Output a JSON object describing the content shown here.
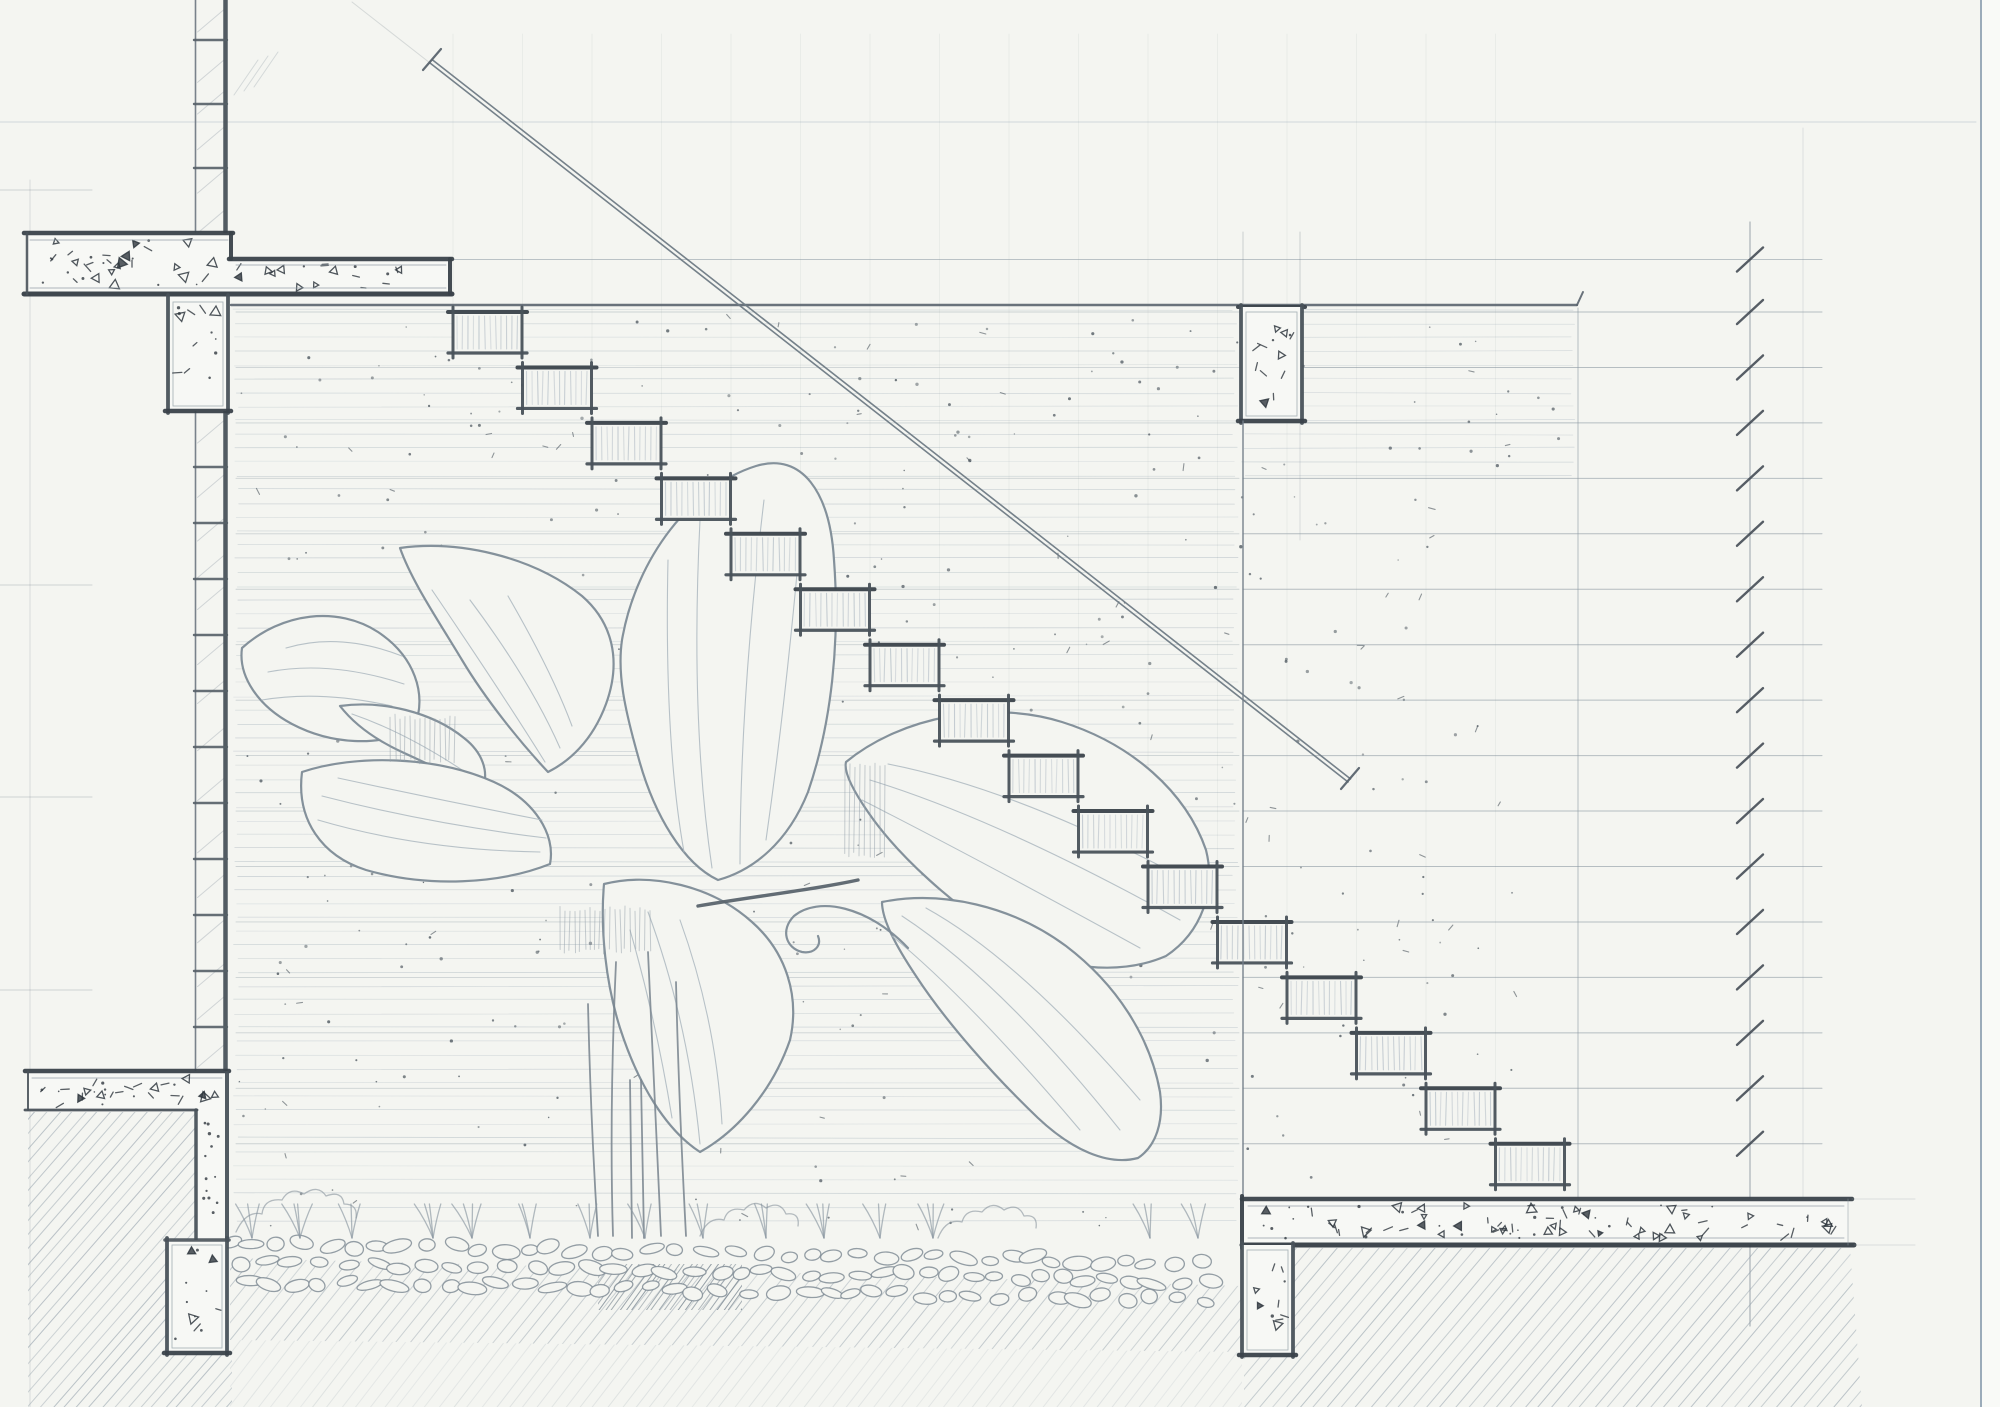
{
  "scene": {
    "width": 2000,
    "height": 1407,
    "rng_seed": 7,
    "palette": {
      "paper": "#f4f5f1",
      "paper_bright": "#f7f8f5",
      "ink_dark": "#3a424a",
      "ink_mid2": "#49525a",
      "ink_med": "#6b7680",
      "ink_light": "#8b98a2",
      "ink_faint": "#aab6bf",
      "step_hatch": "#b3bdc6",
      "leaf": "#7d8b96",
      "leaf_vein": "#a8b4bd",
      "hatch": "#93a0ab",
      "pebble": "#7b8791",
      "border_blue": "#7d92a6",
      "mark": "#2f373e"
    },
    "guides": {
      "top_hline_y": 122,
      "margin_vline_x": 30,
      "margin_tick_ys": [
        190,
        585,
        797,
        990
      ],
      "border_x": 1981,
      "pitch_ext": [
        352,
        2,
        430,
        63
      ]
    },
    "stairs": {
      "count": 16,
      "x0": 453,
      "y0": 312,
      "dx": 69.5,
      "dy": 55.45,
      "tread_w": 69,
      "riser_h": 41
    },
    "pitch": {
      "x1": 430,
      "y1": 63,
      "x2": 1348,
      "y2": 782,
      "gap": 4
    },
    "levels": {
      "tick_x": 1750,
      "line_x0": 1243,
      "line_x1": 1822,
      "first_y": 259.5,
      "spacing": 55.45,
      "count": 17,
      "vline_top": 222,
      "vline_bot": 1326
    },
    "wall_top_line": {
      "y": 305,
      "x0": 231,
      "x1": 1577
    },
    "wall_left": {
      "x_thin": 195.5,
      "x_thick": 225.5,
      "seg1": [
        0,
        232
      ],
      "seg2": [
        411,
        1071
      ],
      "rungs_top": [
        40,
        104,
        168
      ],
      "rung_start": 467,
      "rung_step": 56,
      "rung_end": 1062
    },
    "texture": {
      "bands": [
        {
          "x0": 233,
          "x1": 1238,
          "y0": 310,
          "y1": 1233,
          "step": 13.8
        },
        {
          "x0": 1241,
          "x1": 1576,
          "y0": 310,
          "y1": 479,
          "step": 13.8
        }
      ]
    },
    "stipple_regions": [
      {
        "x": 235,
        "y": 315,
        "w": 1335,
        "h": 163,
        "n": 110
      },
      {
        "x": 235,
        "y": 480,
        "w": 1000,
        "h": 750,
        "n": 240
      },
      {
        "x": 1240,
        "y": 480,
        "w": 278,
        "h": 700,
        "n": 80
      }
    ],
    "extra_vlines": [
      {
        "x": 1578,
        "y0": 308,
        "y1": 1197,
        "w": 1,
        "op": 0.6
      },
      {
        "x": 1803,
        "y0": 128,
        "y1": 1197,
        "w": 0.9,
        "op": 0.25
      },
      {
        "x": 1300,
        "y0": 422,
        "y1": 540,
        "w": 0.9,
        "op": 0.3
      }
    ],
    "concrete": {
      "slab_tl": {
        "rects": [
          [
            27,
            233,
            204,
            61
          ],
          [
            231,
            259,
            219,
            35
          ]
        ],
        "stipple": [
          [
            34,
            240,
            190,
            46,
            34
          ],
          [
            238,
            264,
            202,
            24,
            18
          ]
        ]
      },
      "col_tl": {
        "x": 168,
        "y": 297,
        "w": 60,
        "h": 114,
        "n": 13
      },
      "col_tr": {
        "x": 1241,
        "y": 307,
        "w": 61,
        "h": 114,
        "n": 13,
        "ext_above": 232
      },
      "slab_r": {
        "x": 1242,
        "y": 1199,
        "w": 606,
        "h": 46,
        "n": 85
      },
      "col_br": {
        "x": 1242,
        "y": 1245,
        "w": 51,
        "h": 110,
        "n": 10
      },
      "slab_bl": {
        "band": [
          28,
          1071,
          199,
          40
        ],
        "drop": [
          196,
          1111,
          31,
          130
        ],
        "n_band": 30,
        "n_drop": 13
      },
      "col_bl": {
        "x": 167,
        "y": 1240,
        "w": 60,
        "h": 113,
        "n": 12
      }
    },
    "hatches": [
      {
        "name": "ground-hatch-bottom-left",
        "poly": [
          [
            28,
            1112
          ],
          [
            196,
            1112
          ],
          [
            196,
            1353
          ],
          [
            232,
            1353
          ],
          [
            232,
            1407
          ],
          [
            28,
            1407
          ]
        ],
        "sp": 12.5,
        "op": 0.5
      },
      {
        "name": "ground-hatch-under-pebbles",
        "poly": [
          [
            230,
            1258
          ],
          [
            700,
            1270
          ],
          [
            1242,
            1286
          ],
          [
            1242,
            1352
          ],
          [
            230,
            1340
          ]
        ],
        "sp": 14,
        "op": 0.42
      },
      {
        "name": "ground-hatch-under-pebbles-fade",
        "poly": [
          [
            230,
            1340
          ],
          [
            1242,
            1352
          ],
          [
            1242,
            1407
          ],
          [
            230,
            1407
          ]
        ],
        "sp": 14,
        "op": 0.18
      },
      {
        "name": "ground-hatch-bottom-right",
        "poly": [
          [
            1244,
            1248
          ],
          [
            1850,
            1248
          ],
          [
            1862,
            1407
          ],
          [
            1244,
            1407
          ]
        ],
        "sp": 14,
        "op": 0.5
      },
      {
        "name": "trunk-shadow-hatch",
        "poly": [
          [
            598,
            1264
          ],
          [
            742,
            1264
          ],
          [
            742,
            1310
          ],
          [
            598,
            1310
          ]
        ],
        "sp": 6.5,
        "op": 0.7,
        "color": "#7a8791"
      }
    ],
    "pebbles": {
      "x0": 232,
      "x1": 1232,
      "row_ys": [
        1243,
        1262,
        1281
      ],
      "slope": 0.02
    },
    "sprig_xs": [
      252,
      300,
      352,
      433,
      472,
      530,
      590,
      645,
      703,
      766,
      824,
      880,
      933,
      1150,
      1198
    ],
    "clouds": [
      "M 236 1232 q 10 -22 26 -18 q 2 -16 20 -14 q 8 -14 22 -6 q 14 -10 22 2 q 16 -6 18 8 q 14 0 12 14",
      "M 700 1236 q 8 -20 24 -16 q 4 -14 20 -10 q 10 -12 22 -2 q 14 -8 20 6 q 14 -2 12 12",
      "M 938 1238 q 8 -20 24 -16 q 4 -14 20 -10 q 10 -12 22 -2 q 14 -8 20 6 q 14 -2 12 12"
    ],
    "plant": {
      "leaves": [
        {
          "d": "M 242 648 C 282 612 338 606 378 632 C 414 656 428 694 414 728 C 380 748 330 744 292 724 C 258 706 238 676 242 648 Z",
          "veins": [
            "M 262 700 Q 320 690 392 706",
            "M 268 672 Q 330 660 404 684",
            "M 286 648 Q 340 632 402 656"
          ]
        },
        {
          "d": "M 400 548 C 458 540 532 556 582 596 C 612 622 622 660 606 704 C 592 742 568 762 548 772 C 520 742 486 700 462 660 C 438 620 412 582 400 548 Z",
          "veins": [
            "M 545 762 Q 500 690 432 590",
            "M 560 748 Q 530 680 470 600",
            "M 572 726 Q 552 672 508 596"
          ]
        },
        {
          "d": "M 340 706 C 382 700 432 712 464 738 C 482 752 490 772 482 790 C 458 778 428 764 402 752 C 376 740 354 724 340 706 Z",
          "veins": [
            "M 352 714 Q 410 734 474 778"
          ]
        },
        {
          "d": "M 302 772 C 356 754 436 756 494 782 C 534 800 556 834 550 864 C 500 884 428 888 366 870 C 322 856 296 820 302 772 Z",
          "veins": [
            "M 318 820 Q 420 850 540 852",
            "M 322 796 Q 430 824 546 838",
            "M 338 778 Q 440 800 542 820"
          ]
        },
        {
          "d": "M 604 884 C 652 872 712 886 752 922 C 786 952 800 996 790 1040 C 772 1092 736 1132 700 1152 C 666 1130 638 1084 620 1028 C 606 984 600 930 604 884 Z",
          "veins": [
            "M 700 1144 Q 688 1020 648 912",
            "M 722 1124 Q 716 1020 680 920",
            "M 672 1118 Q 656 1020 630 930"
          ]
        },
        {
          "d": "M 622 640 C 636 558 692 486 756 466 C 802 452 830 492 834 560 C 840 640 832 722 808 792 C 788 842 754 870 718 880 C 684 864 654 816 638 756 C 625 710 617 674 622 640 Z",
          "veins": [
            "M 712 868 Q 690 720 700 520",
            "M 740 864 Q 740 700 764 500",
            "M 684 852 Q 664 740 668 560",
            "M 766 840 Q 786 700 800 540"
          ]
        },
        {
          "d": "M 846 762 C 902 716 992 700 1062 722 C 1132 744 1186 792 1206 850 C 1216 890 1202 932 1166 956 C 1120 976 1058 970 1008 940 C 954 906 898 856 868 812 C 850 786 844 770 846 762 Z",
          "veins": [
            "M 870 780 Q 1000 820 1180 920",
            "M 888 764 Q 1010 788 1168 870",
            "M 862 800 Q 980 860 1140 948"
          ]
        },
        {
          "d": "M 882 902 C 942 890 1012 906 1066 946 C 1116 984 1150 1036 1160 1092 C 1164 1122 1156 1146 1138 1158 C 1108 1166 1072 1150 1038 1118 C 994 1076 946 1022 916 976 C 896 946 882 920 882 902 Z",
          "veins": [
            "M 902 916 Q 1000 980 1120 1130",
            "M 926 908 Q 1020 960 1140 1100",
            "M 892 936 Q 970 1000 1080 1130"
          ]
        }
      ],
      "curl": "M 908 948 C 868 906 818 896 794 916 C 780 930 786 948 802 952 C 814 954 822 946 818 936",
      "midrib": "M 698 906 C 756 896 812 890 858 880",
      "stems": [
        "M 616 962 C 612 1050 610 1140 613 1236",
        "M 648 952 C 652 1050 657 1146 661 1236",
        "M 588 1004 C 590 1090 594 1174 598 1236",
        "M 676 982 C 678 1070 682 1160 686 1236",
        "M 630 1080 L 632 1238",
        "M 641 1080 L 644 1238"
      ],
      "patches": [
        {
          "x": 390,
          "y": 714,
          "w": 66,
          "h": 50,
          "gap": 5
        },
        {
          "x": 845,
          "y": 762,
          "w": 44,
          "h": 96,
          "gap": 5
        },
        {
          "x": 560,
          "y": 906,
          "w": 90,
          "h": 48,
          "gap": 5
        }
      ]
    }
  }
}
